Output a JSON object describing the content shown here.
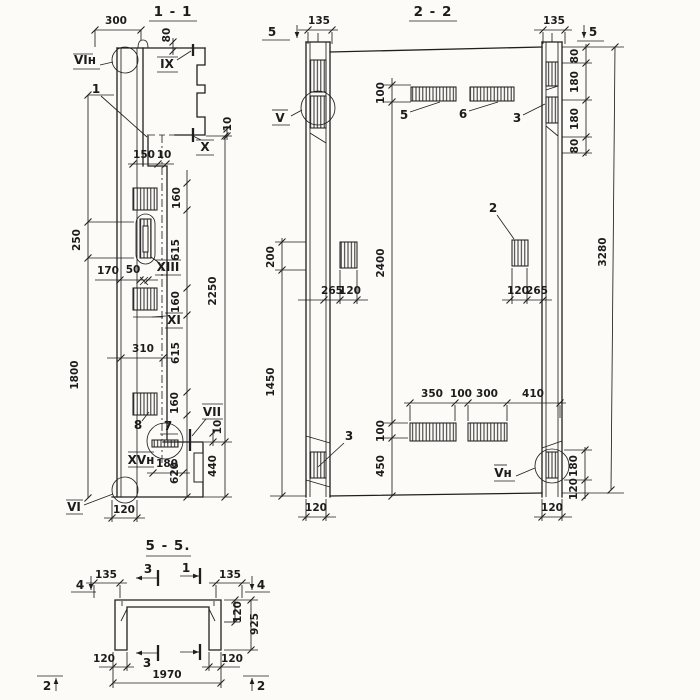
{
  "s11": {
    "title": "1 - 1",
    "d300": "300",
    "d80": "80",
    "d150": "150",
    "d10a": "10",
    "d10b": "10",
    "d10c": "10",
    "d160a": "160",
    "d615a": "615",
    "d160b": "160",
    "d615b": "615",
    "d160c": "160",
    "d250": "250",
    "d170": "170",
    "d50": "50",
    "d2250": "2250",
    "d310": "310",
    "d1800": "1800",
    "d180": "180",
    "d620": "620",
    "d440": "440",
    "d120": "120",
    "lVIn": "VIн",
    "l1": "1",
    "lIX": "IX",
    "lX": "X",
    "lXIII": "XIII",
    "lXI": "XI",
    "l7": "7",
    "l8": "8",
    "lVII": "VII",
    "lXVn": "XVн",
    "lVI": "VI"
  },
  "s22": {
    "title": "2 - 2",
    "cut5L": "5",
    "cut5R": "5",
    "d135L": "135",
    "d135R": "135",
    "d80a": "80",
    "d180a": "180",
    "d180b": "180",
    "d80b": "80",
    "d3280": "3280",
    "d100t": "100",
    "d2400": "2400",
    "d100b": "100",
    "d450": "450",
    "d200": "200",
    "d1450": "1450",
    "d265L": "265",
    "d120L": "120",
    "d120R": "120",
    "d265R": "265",
    "d350": "350",
    "d100m": "100",
    "d300": "300",
    "d410": "410",
    "d180r": "180",
    "d120r": "120",
    "d120bl": "120",
    "d120br": "120",
    "lV": "V",
    "l5": "5",
    "l6": "6",
    "l3a": "3",
    "l2": "2",
    "l3b": "3",
    "lVn": "Vн"
  },
  "s55": {
    "title": "5 - 5.",
    "m4L": "4",
    "m4R": "4",
    "m3t": "3",
    "m1t": "1",
    "m3b": "3",
    "m2L": "2",
    "m2R": "2",
    "d135L": "135",
    "d135R": "135",
    "d120s": "120",
    "d925": "925",
    "d120bl": "120",
    "d120br": "120",
    "d1970": "1970"
  }
}
